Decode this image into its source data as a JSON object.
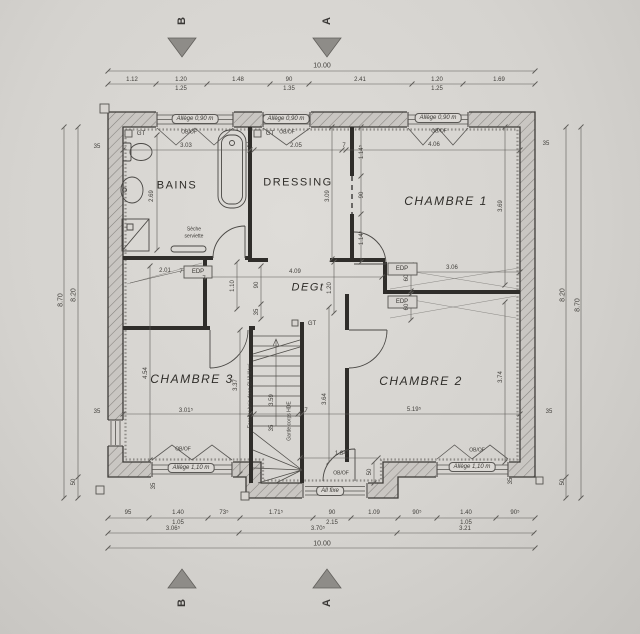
{
  "document": {
    "type": "floor-plan-scan",
    "overall_width_m": "10.00",
    "overall_depth_m": "8.70"
  },
  "colors": {
    "paper": "#d6d3cf",
    "ink": "#3c3a37",
    "wall_fill": "#2f2d2a",
    "hatch": "#85827e",
    "marker_gray": "#8e8c88"
  },
  "rooms_list": [
    "BAINS",
    "DRESSING",
    "CHAMBRE 1",
    "CHAMBRE 2",
    "CHAMBRE 3",
    "DEGt"
  ],
  "section_markers": {
    "top_b": "B",
    "top_a": "A",
    "bottom_b": "B",
    "bottom_a": "A"
  },
  "labels": {
    "rooms": [
      {
        "n": "room-label-bains",
        "t": "BAINS",
        "x": 177,
        "y": 186,
        "s": 11,
        "c": "room"
      },
      {
        "n": "room-label-dressing",
        "t": "DRESSING",
        "x": 298,
        "y": 183,
        "s": 11,
        "c": "room"
      },
      {
        "n": "room-label-chambre1",
        "t": "CHAMBRE 1",
        "x": 446,
        "y": 201,
        "s": 12,
        "c": "room it"
      },
      {
        "n": "room-label-degt",
        "t": "DEGt",
        "x": 308,
        "y": 288,
        "s": 11,
        "c": "room it"
      },
      {
        "n": "room-label-chambre3",
        "t": "CHAMBRE 3",
        "x": 192,
        "y": 379,
        "s": 12,
        "c": "room it"
      },
      {
        "n": "room-label-chambre2",
        "t": "CHAMBRE 2",
        "x": 421,
        "y": 381,
        "s": 12,
        "c": "room it"
      }
    ],
    "windows": [
      {
        "n": "window-label-top-1",
        "t": "Allège 0,90 m",
        "x": 195,
        "y": 119,
        "s": 6,
        "c": "winlab"
      },
      {
        "n": "window-label-top-2",
        "t": "Allège 0,90 m",
        "x": 286,
        "y": 119,
        "s": 6,
        "c": "winlab"
      },
      {
        "n": "window-label-top-3",
        "t": "Allège 0,90 m",
        "x": 438,
        "y": 118,
        "s": 6,
        "c": "winlab"
      },
      {
        "n": "window-label-bottom-left",
        "t": "Allège 1,10 m",
        "x": 191,
        "y": 468,
        "s": 6,
        "c": "winlab"
      },
      {
        "n": "window-label-bottom-right",
        "t": "Allège 1,10 m",
        "x": 472,
        "y": 467,
        "s": 6,
        "c": "winlab"
      },
      {
        "n": "window-label-all-fixe",
        "t": "All fixe",
        "x": 330,
        "y": 491,
        "s": 6,
        "c": "winlab"
      }
    ],
    "annotations": [
      {
        "n": "gt-tag-bains",
        "t": "GT",
        "x": 141,
        "y": 134,
        "s": 6,
        "c": "note"
      },
      {
        "n": "gt-tag-dressing",
        "t": "GT",
        "x": 270,
        "y": 134,
        "s": 6,
        "c": "note"
      },
      {
        "n": "gt-tag-stairs",
        "t": "GT",
        "x": 312,
        "y": 324,
        "s": 6,
        "c": "note"
      },
      {
        "n": "edp-tag-left",
        "t": "EDP",
        "x": 198,
        "y": 272,
        "s": 6,
        "c": "note"
      },
      {
        "n": "edp-tag-right-1",
        "t": "EDP",
        "x": 402,
        "y": 269,
        "s": 6,
        "c": "note"
      },
      {
        "n": "edp-tag-right-2",
        "t": "EDP",
        "x": 402,
        "y": 302,
        "s": 6,
        "c": "note"
      },
      {
        "n": "towel-dryer-label-1",
        "t": "Sèche",
        "x": 194,
        "y": 230,
        "s": 5,
        "c": "note"
      },
      {
        "n": "towel-dryer-label-2",
        "t": "serviette",
        "x": 194,
        "y": 237,
        "s": 5,
        "c": "note"
      },
      {
        "n": "stair-note",
        "t": "Escalier bois dans CH 'Hêtre'",
        "x": 251,
        "y": 396,
        "r": -90,
        "s": 5,
        "c": "note"
      },
      {
        "n": "guardrail-note",
        "t": "Garde corps HDE",
        "x": 290,
        "y": 421,
        "r": -90,
        "s": 5,
        "c": "note"
      },
      {
        "n": "obof-1",
        "t": "OB/OF",
        "x": 189,
        "y": 133,
        "s": 5,
        "c": "note"
      },
      {
        "n": "obof-2",
        "t": "OB/OF",
        "x": 287,
        "y": 133,
        "s": 5,
        "c": "note"
      },
      {
        "n": "obof-3",
        "t": "OB/OF",
        "x": 439,
        "y": 132,
        "s": 5,
        "c": "note"
      },
      {
        "n": "obof-4",
        "t": "OB/OF",
        "x": 183,
        "y": 450,
        "s": 5,
        "c": "note"
      },
      {
        "n": "obof-5",
        "t": "OB/OF",
        "x": 477,
        "y": 451,
        "s": 5,
        "c": "note"
      },
      {
        "n": "obof-6",
        "t": "OB/OF",
        "x": 341,
        "y": 474,
        "s": 5,
        "c": "note"
      }
    ],
    "top_dims": [
      {
        "n": "dim-top-overall",
        "t": "10.00",
        "x": 322,
        "y": 66,
        "s": 7
      },
      {
        "n": "dim-top-1",
        "t": "1.12",
        "x": 132,
        "y": 80
      },
      {
        "n": "dim-top-2a",
        "t": "1.20",
        "x": 181,
        "y": 80
      },
      {
        "n": "dim-top-2b",
        "t": "1.25",
        "x": 181,
        "y": 89
      },
      {
        "n": "dim-top-3",
        "t": "1.48",
        "x": 238,
        "y": 80
      },
      {
        "n": "dim-top-4a",
        "t": "90",
        "x": 289,
        "y": 80
      },
      {
        "n": "dim-top-4b",
        "t": "1.35",
        "x": 289,
        "y": 89
      },
      {
        "n": "dim-top-5",
        "t": "2.41",
        "x": 360,
        "y": 80
      },
      {
        "n": "dim-top-6a",
        "t": "1.20",
        "x": 437,
        "y": 80
      },
      {
        "n": "dim-top-6b",
        "t": "1.25",
        "x": 437,
        "y": 89
      },
      {
        "n": "dim-top-7",
        "t": "1.69",
        "x": 499,
        "y": 80
      }
    ],
    "bottom_dims": [
      {
        "n": "dim-bot-1",
        "t": "95",
        "x": 128,
        "y": 513
      },
      {
        "n": "dim-bot-2a",
        "t": "1.40",
        "x": 178,
        "y": 513
      },
      {
        "n": "dim-bot-2b",
        "t": "1.05",
        "x": 178,
        "y": 523
      },
      {
        "n": "dim-bot-3",
        "t": "73⁵",
        "x": 224,
        "y": 513
      },
      {
        "n": "dim-bot-4",
        "t": "1.71⁵",
        "x": 276,
        "y": 513
      },
      {
        "n": "dim-bot-5a",
        "t": "90",
        "x": 332,
        "y": 513
      },
      {
        "n": "dim-bot-5b",
        "t": "2.15",
        "x": 332,
        "y": 523
      },
      {
        "n": "dim-bot-6",
        "t": "1.09",
        "x": 374,
        "y": 513
      },
      {
        "n": "dim-bot-7",
        "t": "90⁵",
        "x": 417,
        "y": 513
      },
      {
        "n": "dim-bot-8a",
        "t": "1.40",
        "x": 466,
        "y": 513
      },
      {
        "n": "dim-bot-8b",
        "t": "1.05",
        "x": 466,
        "y": 523
      },
      {
        "n": "dim-bot-9",
        "t": "90⁵",
        "x": 515,
        "y": 513
      },
      {
        "n": "dim-bot-10",
        "t": "3.06⁵",
        "x": 173,
        "y": 529
      },
      {
        "n": "dim-bot-11",
        "t": "3.70⁵",
        "x": 318,
        "y": 529
      },
      {
        "n": "dim-bot-12",
        "t": "3.21",
        "x": 465,
        "y": 529
      },
      {
        "n": "dim-bot-overall",
        "t": "10.00",
        "x": 322,
        "y": 544,
        "s": 7
      }
    ],
    "side_dims": [
      {
        "n": "dim-left-870",
        "t": "8.70",
        "x": 61,
        "y": 300,
        "r": -90,
        "s": 7
      },
      {
        "n": "dim-left-820",
        "t": "8.20",
        "x": 74,
        "y": 295,
        "r": -90,
        "s": 7
      },
      {
        "n": "dim-left-50",
        "t": "50",
        "x": 74,
        "y": 482,
        "r": -90
      },
      {
        "n": "dim-right-820",
        "t": "8.20",
        "x": 563,
        "y": 295,
        "r": -90,
        "s": 7
      },
      {
        "n": "dim-right-50",
        "t": "50",
        "x": 563,
        "y": 482,
        "r": -90
      },
      {
        "n": "dim-right-870",
        "t": "8.70",
        "x": 578,
        "y": 305,
        "r": -90,
        "s": 7
      },
      {
        "n": "dim-wall-35-tl",
        "t": "35",
        "x": 97,
        "y": 147
      },
      {
        "n": "dim-wall-35-bl",
        "t": "35",
        "x": 97,
        "y": 412
      },
      {
        "n": "dim-wall-35-tr",
        "t": "35",
        "x": 546,
        "y": 144
      },
      {
        "n": "dim-wall-35-br",
        "t": "35",
        "x": 549,
        "y": 412
      },
      {
        "n": "dim-win-35-bl",
        "t": "35",
        "x": 154,
        "y": 486,
        "r": -90
      },
      {
        "n": "dim-win-35-br",
        "t": "35",
        "x": 511,
        "y": 481,
        "r": -90
      }
    ],
    "interior_dims": [
      {
        "n": "dim-bains-width",
        "t": "3.03",
        "x": 186,
        "y": 146
      },
      {
        "n": "dim-7-1",
        "t": "7",
        "x": 248,
        "y": 146
      },
      {
        "n": "dim-dressing-width",
        "t": "2.05",
        "x": 296,
        "y": 146
      },
      {
        "n": "dim-7-2",
        "t": "7",
        "x": 344,
        "y": 146
      },
      {
        "n": "dim-ch1-width",
        "t": "4.06",
        "x": 434,
        "y": 145
      },
      {
        "n": "dim-bains-depth",
        "t": "2.69",
        "x": 152,
        "y": 196,
        "r": -90
      },
      {
        "n": "dim-dressing-depth",
        "t": "3.09",
        "x": 328,
        "y": 196,
        "r": -90
      },
      {
        "n": "dim-ch1-seg-1",
        "t": "1.14⁵",
        "x": 362,
        "y": 152,
        "r": -90
      },
      {
        "n": "dim-ch1-door",
        "t": "90",
        "x": 362,
        "y": 195,
        "r": -90
      },
      {
        "n": "dim-ch1-seg-2",
        "t": "1.14⁵",
        "x": 362,
        "y": 238,
        "r": -90
      },
      {
        "n": "dim-ch1-depth",
        "t": "3.69",
        "x": 501,
        "y": 206,
        "r": -90
      },
      {
        "n": "dim-deg-width",
        "t": "4.09",
        "x": 295,
        "y": 272
      },
      {
        "n": "dim-7-3",
        "t": "7",
        "x": 204,
        "y": 279
      },
      {
        "n": "dim-7-4",
        "t": "7",
        "x": 385,
        "y": 279
      },
      {
        "n": "dim-7-5",
        "t": "7",
        "x": 181,
        "y": 272
      },
      {
        "n": "dim-wall-306",
        "t": "3.06",
        "x": 452,
        "y": 268
      },
      {
        "n": "dim-60-1",
        "t": "60",
        "x": 407,
        "y": 278,
        "r": -90
      },
      {
        "n": "dim-60-2",
        "t": "60",
        "x": 407,
        "y": 307,
        "r": -90
      },
      {
        "n": "dim-deg-110",
        "t": "1.10",
        "x": 233,
        "y": 286,
        "r": -90
      },
      {
        "n": "dim-deg-90",
        "t": "90",
        "x": 257,
        "y": 285,
        "r": -90
      },
      {
        "n": "dim-deg-35",
        "t": "35",
        "x": 257,
        "y": 312,
        "r": -90
      },
      {
        "n": "dim-deg-120",
        "t": "1.20",
        "x": 330,
        "y": 288,
        "r": -90
      },
      {
        "n": "dim-left-201",
        "t": "2.01",
        "x": 165,
        "y": 271
      },
      {
        "n": "dim-ch3-depth",
        "t": "4.54",
        "x": 146,
        "y": 373,
        "r": -90
      },
      {
        "n": "dim-ch3-right",
        "t": "3.37",
        "x": 236,
        "y": 385,
        "r": -90
      },
      {
        "n": "dim-ch3-width",
        "t": "3.01⁵",
        "x": 186,
        "y": 411
      },
      {
        "n": "dim-7-6",
        "t": "7",
        "x": 250,
        "y": 411
      },
      {
        "n": "dim-7-7",
        "t": "7",
        "x": 306,
        "y": 411
      },
      {
        "n": "dim-ch2-width",
        "t": "5.19⁵",
        "x": 414,
        "y": 410
      },
      {
        "n": "dim-ch2-left",
        "t": "3.64",
        "x": 325,
        "y": 399,
        "r": -90
      },
      {
        "n": "dim-ch2-right",
        "t": "3.74",
        "x": 501,
        "y": 377,
        "r": -90
      },
      {
        "n": "dim-bot-door",
        "t": "1.84⁵",
        "x": 342,
        "y": 454
      },
      {
        "n": "dim-bump-50",
        "t": "50",
        "x": 370,
        "y": 472,
        "r": -90
      },
      {
        "n": "dim-stair-359",
        "t": "3.59",
        "x": 272,
        "y": 400,
        "r": -90
      },
      {
        "n": "dim-stair-35",
        "t": "35",
        "x": 272,
        "y": 428,
        "r": -90
      }
    ]
  }
}
